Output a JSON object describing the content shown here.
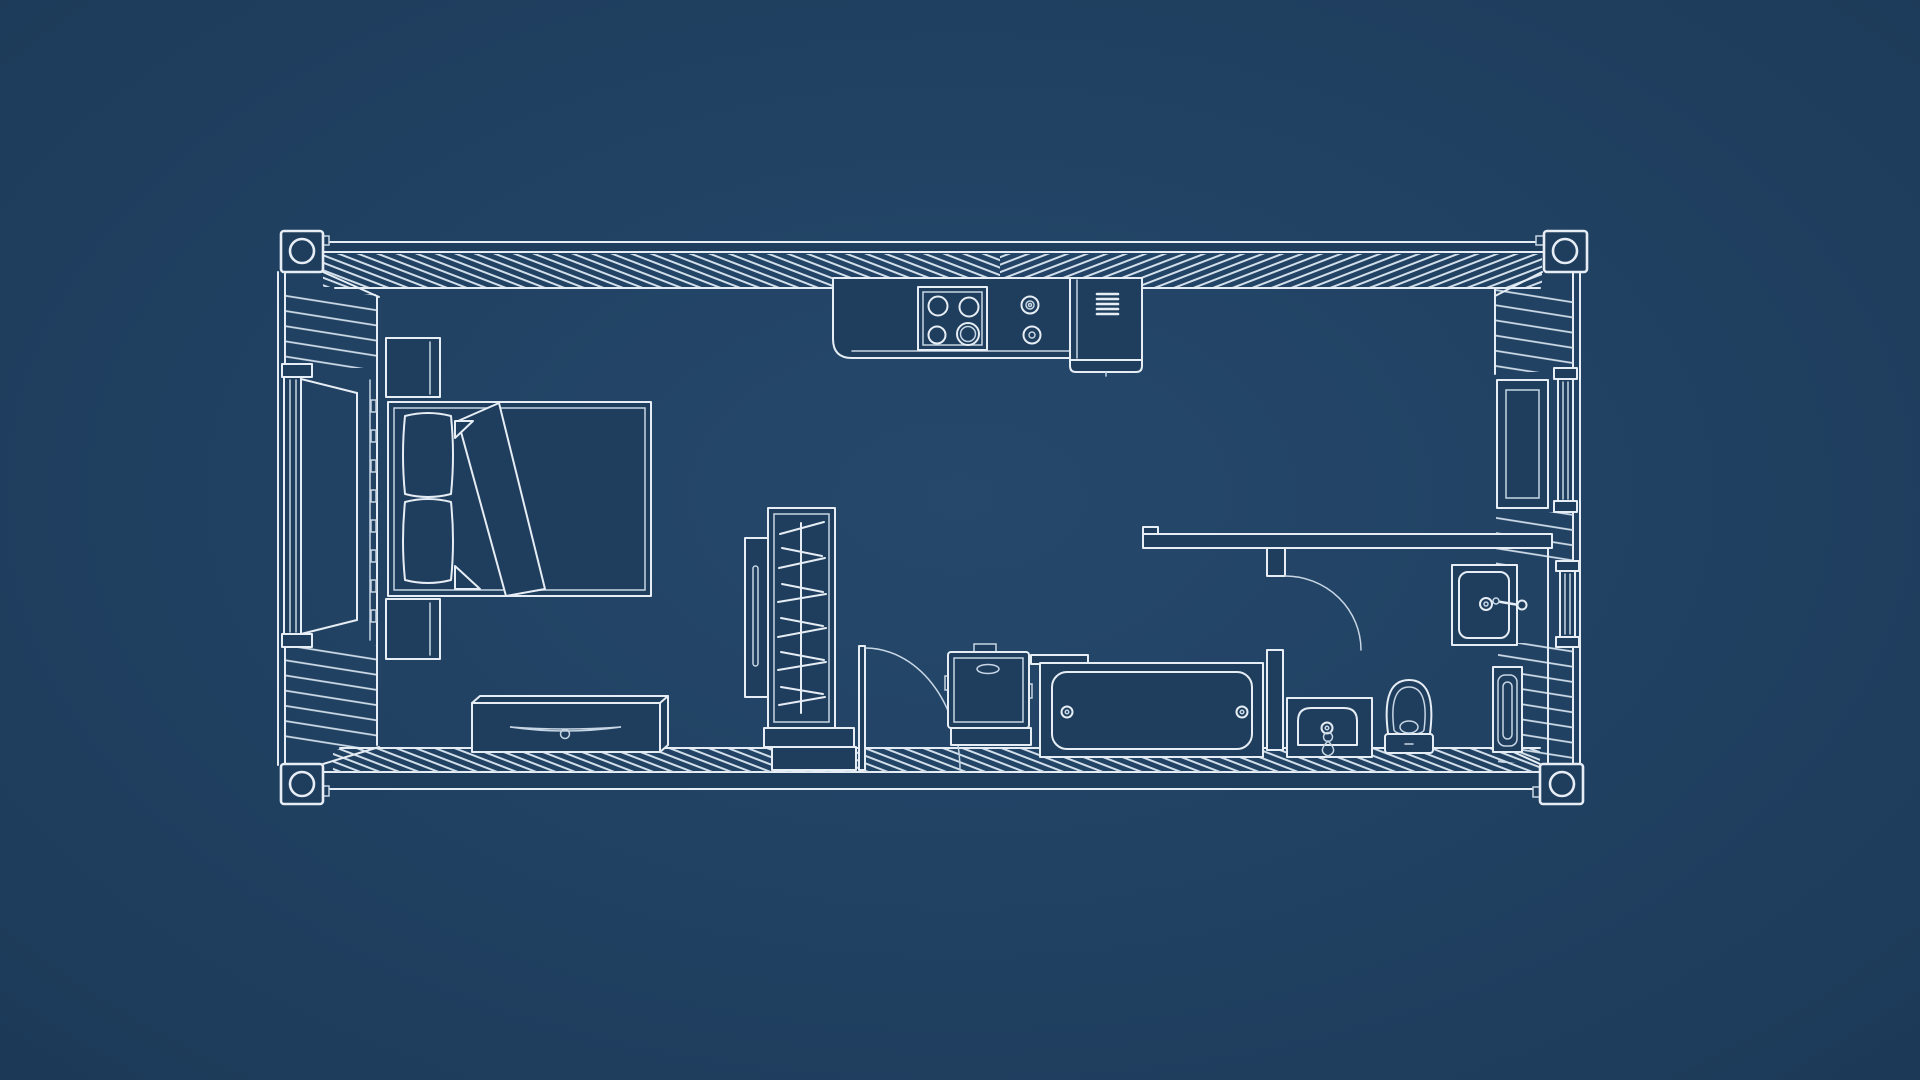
{
  "title": "Shipping container tiny home floor plan blueprint, top view",
  "style": {
    "background_center": "#25486b",
    "background_mid": "#1f3e5e",
    "background_edge": "#122741",
    "surface_fill": "#1f3e5e",
    "line_primary": "#e6edf4",
    "line_secondary": "#c7d6e4",
    "hatch_line": "#d2dfea"
  },
  "plan": {
    "drawing_type": "floor-plan-top-view",
    "structure": "shipping-container",
    "corner_castings": 4,
    "rooms": [
      {
        "name": "bedroom",
        "fixtures": [
          "bed",
          "pillow-left",
          "pillow-right",
          "blanket",
          "nightstand-upper",
          "nightstand-lower",
          "dresser",
          "window-left"
        ]
      },
      {
        "name": "kitchen",
        "fixtures": [
          "counter",
          "cooktop-4-burner",
          "control-knobs",
          "refrigerator"
        ]
      },
      {
        "name": "hallway",
        "fixtures": [
          "wardrobe-side-panel",
          "wardrobe",
          "clothes-hangers",
          "wardrobe-base",
          "interior-door",
          "water-heater",
          "bathtub"
        ]
      },
      {
        "name": "bathroom",
        "fixtures": [
          "partition-wall",
          "bathroom-door",
          "wall-mounted-sink",
          "vanity-sink",
          "toilet",
          "storage-cabinet",
          "window-right-upper",
          "window-right-lower"
        ]
      }
    ]
  }
}
